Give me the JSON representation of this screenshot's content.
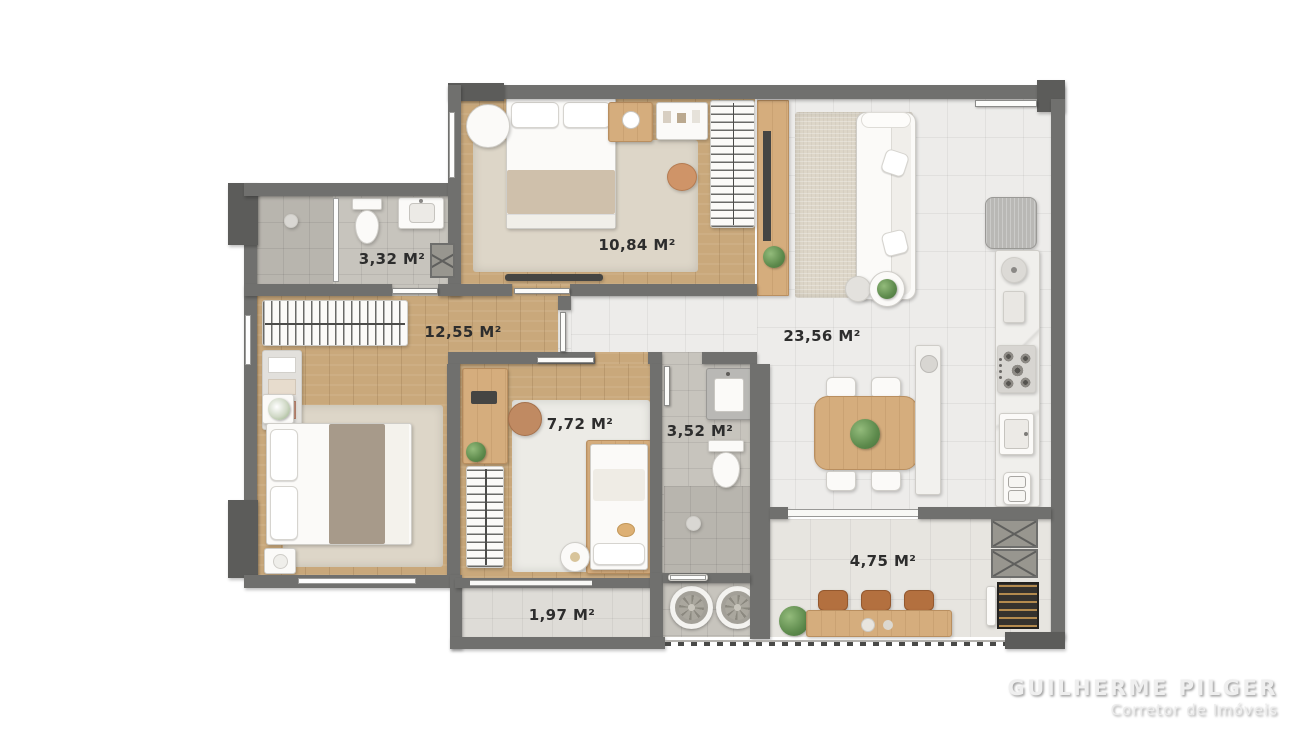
{
  "plan": {
    "type": "apartment-floor-plan-top-view",
    "rooms": {
      "suite_bath": {
        "name": "ensuite-bathroom",
        "area": "3,32 M²"
      },
      "bedroom2": {
        "name": "bedroom-2",
        "area": "10,84 M²"
      },
      "suite": {
        "name": "master-suite",
        "area": "12,55 M²"
      },
      "bedroom3": {
        "name": "bedroom-3-office",
        "area": "7,72 M²"
      },
      "bathroom": {
        "name": "social-bathroom",
        "area": "3,52 M²"
      },
      "living_kitchen": {
        "name": "living-dining-kitchen",
        "area": "23,56 M²"
      },
      "balcony": {
        "name": "terrace-balcony",
        "area": "4,75 M²"
      },
      "service_balcony": {
        "name": "service-balcony",
        "area": "1,97 M²"
      }
    },
    "colors": {
      "wall": "#70706e",
      "wall_dark": "#5c5c5a",
      "wood_floor": "#c9a87b",
      "tile_floor": "#edecea",
      "bath_tile": "#c7c4bd",
      "rug": "#ddd6c8",
      "accent_wood": "#d5ad7d",
      "label_text": "#2d2d2d",
      "plant_green": "#5d8a4c",
      "terracotta": "#c08a62"
    }
  },
  "watermark": {
    "name": "GUILHERME PILGER",
    "role": "Corretor de Imóveis"
  }
}
